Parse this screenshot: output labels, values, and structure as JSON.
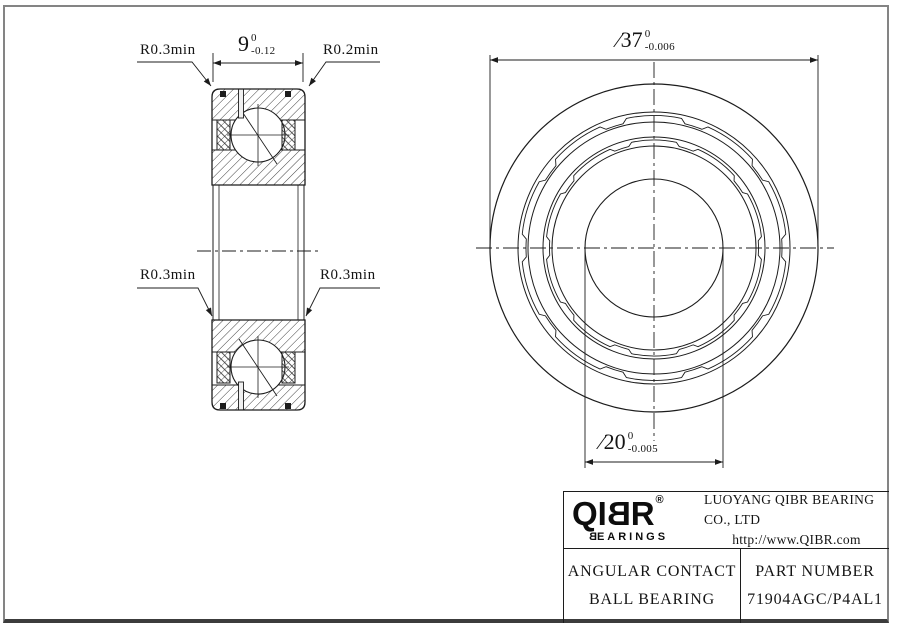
{
  "side_view": {
    "width_dim": {
      "value": "9",
      "tol_top": "0",
      "tol_bottom": "-0.12"
    },
    "radius_labels": {
      "top_left": "R0.3min",
      "top_right": "R0.2min",
      "mid_left": "R0.3min",
      "mid_right": "R0.3min"
    }
  },
  "front_view": {
    "outer_dim": {
      "value": "∕37",
      "tol_top": "0",
      "tol_bottom": "-0.006"
    },
    "bore_dim": {
      "value": "∕20",
      "tol_top": "0",
      "tol_bottom": "-0.005"
    }
  },
  "title_block": {
    "logo": {
      "l0": "Q",
      "l1": "I",
      "l2": "B",
      "l3": "R",
      "registered": "®",
      "s0": "B",
      "s1": "EARINGS"
    },
    "company": "LUOYANG QIBR BEARING CO., LTD",
    "website": "http://www.QIBR.com",
    "product_line1": "ANGULAR CONTACT",
    "product_line2": "BALL BEARING",
    "part_label": "PART NUMBER",
    "part_number": "71904AGC/P4AL1"
  },
  "colors": {
    "line": "#1c1c1c",
    "frame": "#848484"
  }
}
